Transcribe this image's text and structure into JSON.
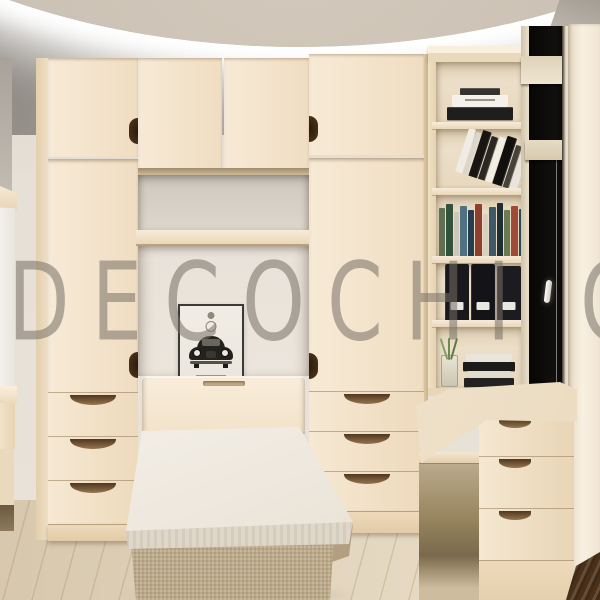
{
  "watermark": {
    "text": "DECOCHI",
    "partial_letter": "O"
  },
  "scene": {
    "title": "Cream bedroom interior 3D render",
    "elements": [
      "cove-lit ceiling",
      "left wardrobe with drawers",
      "overhead bridge cabinets",
      "wall niche with shelf",
      "framed vintage beetle car poster",
      "fold-down single bed with fabric base",
      "right wardrobe with drawers",
      "open bookshelf tower",
      "corner desk with drawer pedestal",
      "black night window with handle",
      "light wood plank floor",
      "dark wood strip bottom right"
    ]
  },
  "palette": {
    "cabinet": "#f4e5cf",
    "cabinet_shade": "#e9d5b6",
    "wall": "#e7e0d7",
    "alcove_wall": "#eae3da",
    "soffit": "#a39c93",
    "ceiling": "#c9bfb2",
    "cove_glow": "#ffffff",
    "floor": "#ddcfb6",
    "bed_base": "#c8b493",
    "mattress": "#f8f4ed",
    "window_glass": "#0b0a09",
    "window_frame": "#e7ddc9",
    "dark_wood": "#4a3018",
    "handle_notch": "#33200f",
    "watermark_gray": "rgba(118,112,102,0.55)"
  },
  "poster": {
    "subject": "vintage beetle car print",
    "frame_color": "#3c3a35",
    "paper_color": "#f0ece4",
    "car_color": "#24221f"
  },
  "books": {
    "stacked_top": [
      {
        "c": "#35322e",
        "w": 40,
        "h": 7
      },
      {
        "c": "#f4f1ea",
        "w": 56,
        "h": 12,
        "label": true
      },
      {
        "c": "#201e1c",
        "w": 66,
        "h": 13
      }
    ],
    "leaning": [
      {
        "c": "#efece4",
        "w": 7,
        "h": 46
      },
      {
        "c": "#dbd6cb",
        "w": 5,
        "h": 44
      },
      {
        "c": "#181512",
        "w": 9,
        "h": 48
      },
      {
        "c": "#2b2723",
        "w": 7,
        "h": 45
      },
      {
        "c": "#f1eee6",
        "w": 6,
        "h": 47
      },
      {
        "c": "#11100e",
        "w": 10,
        "h": 50
      },
      {
        "c": "#474239",
        "w": 6,
        "h": 44
      },
      {
        "c": "#e9e5dc",
        "w": 7,
        "h": 46
      }
    ],
    "row": [
      {
        "c": "#5f7050",
        "w": 6,
        "h": 48
      },
      {
        "c": "#32523e",
        "w": 7,
        "h": 52
      },
      {
        "c": "#cdc7b8",
        "w": 5,
        "h": 44
      },
      {
        "c": "#4f7182",
        "w": 7,
        "h": 50
      },
      {
        "c": "#253d4e",
        "w": 6,
        "h": 46
      },
      {
        "c": "#8e3f2f",
        "w": 7,
        "h": 52
      },
      {
        "c": "#d8d1c2",
        "w": 5,
        "h": 42
      },
      {
        "c": "#3d5a66",
        "w": 7,
        "h": 49
      },
      {
        "c": "#1f2d35",
        "w": 6,
        "h": 53
      },
      {
        "c": "#6a7b53",
        "w": 6,
        "h": 46
      },
      {
        "c": "#a04a38",
        "w": 7,
        "h": 50
      },
      {
        "c": "#2c4a54",
        "w": 6,
        "h": 47
      },
      {
        "c": "#c4bcab",
        "w": 5,
        "h": 43
      },
      {
        "c": "#28282a",
        "w": 7,
        "h": 51
      }
    ],
    "binders": [
      {
        "c": "#19181c",
        "w": 24,
        "h": 56,
        "label": true
      },
      {
        "c": "#141318",
        "w": 24,
        "h": 56,
        "label": true
      },
      {
        "c": "#1c1b20",
        "w": 24,
        "h": 54,
        "label": true
      }
    ],
    "bottom_stack": [
      {
        "c": "#e9e5da",
        "w": 46,
        "h": 8
      },
      {
        "c": "#1c1b19",
        "w": 52,
        "h": 9
      },
      {
        "c": "#dfdacd",
        "w": 44,
        "h": 7
      },
      {
        "c": "#232220",
        "w": 50,
        "h": 9
      }
    ]
  }
}
